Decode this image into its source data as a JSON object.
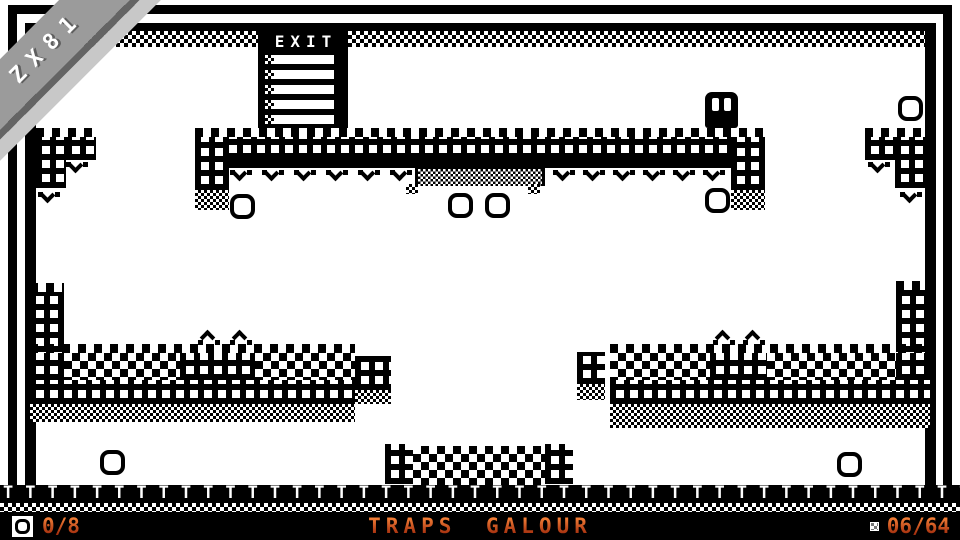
{
  "ribbon": {
    "label": "ZX81"
  },
  "exit_sign": {
    "label": "EXIT",
    "rung_count": 5
  },
  "hud": {
    "coin_counter": "0/8",
    "level_title": "TRAPS GALOUR",
    "block_counter": "06/64"
  },
  "colors": {
    "hud_accent_top": "#f58138",
    "hud_accent_bottom": "#992408",
    "ribbon_gray": "#9b9b9b",
    "ribbon_dark_edge": "#646464",
    "ribbon_light_shadow": "#c8c8c8",
    "ink": "#000000",
    "paper": "#ffffff"
  },
  "rail": {
    "post_count": 44
  },
  "level": {
    "blocks": [
      {
        "t": "dither4",
        "x": 36,
        "y": 31,
        "w": 889,
        "h": 16
      },
      {
        "t": "teeth",
        "x": 195,
        "y": 128,
        "w": 570,
        "h": 9
      },
      {
        "t": "lattice",
        "x": 195,
        "y": 137,
        "w": 570,
        "h": 22
      },
      {
        "t": "solid",
        "x": 195,
        "y": 159,
        "w": 570,
        "h": 9
      },
      {
        "t": "lattice",
        "x": 195,
        "y": 137,
        "w": 34,
        "h": 53
      },
      {
        "t": "dither",
        "x": 195,
        "y": 190,
        "w": 34,
        "h": 20
      },
      {
        "t": "lattice",
        "x": 731,
        "y": 137,
        "w": 34,
        "h": 53
      },
      {
        "t": "dither",
        "x": 731,
        "y": 190,
        "w": 34,
        "h": 20
      },
      {
        "t": "conveyor",
        "x": 415,
        "y": 166,
        "w": 130,
        "h": 20
      },
      {
        "t": "dither",
        "x": 406,
        "y": 184,
        "w": 12,
        "h": 10
      },
      {
        "t": "dither",
        "x": 528,
        "y": 184,
        "w": 12,
        "h": 10
      },
      {
        "t": "teeth",
        "x": 36,
        "y": 128,
        "w": 60,
        "h": 9
      },
      {
        "t": "lattice",
        "x": 36,
        "y": 137,
        "w": 30,
        "h": 51
      },
      {
        "t": "lattice",
        "x": 66,
        "y": 137,
        "w": 30,
        "h": 23
      },
      {
        "t": "teeth",
        "x": 865,
        "y": 128,
        "w": 60,
        "h": 9
      },
      {
        "t": "lattice",
        "x": 895,
        "y": 137,
        "w": 30,
        "h": 51
      },
      {
        "t": "lattice",
        "x": 865,
        "y": 137,
        "w": 30,
        "h": 23
      },
      {
        "t": "teeth",
        "x": 30,
        "y": 283,
        "w": 34,
        "h": 9
      },
      {
        "t": "lattice",
        "x": 30,
        "y": 292,
        "w": 34,
        "h": 60
      },
      {
        "t": "teeth",
        "x": 896,
        "y": 281,
        "w": 34,
        "h": 9
      },
      {
        "t": "lattice",
        "x": 896,
        "y": 290,
        "w": 34,
        "h": 62
      },
      {
        "t": "teeth",
        "x": 30,
        "y": 344,
        "w": 325,
        "h": 9
      },
      {
        "t": "lattice",
        "x": 30,
        "y": 353,
        "w": 34,
        "h": 27
      },
      {
        "t": "checker",
        "x": 64,
        "y": 353,
        "w": 116,
        "h": 27
      },
      {
        "t": "lattice",
        "x": 180,
        "y": 353,
        "w": 75,
        "h": 27
      },
      {
        "t": "checker",
        "x": 255,
        "y": 353,
        "w": 100,
        "h": 27
      },
      {
        "t": "lattice",
        "x": 30,
        "y": 380,
        "w": 325,
        "h": 24
      },
      {
        "t": "dither",
        "x": 30,
        "y": 404,
        "w": 325,
        "h": 18
      },
      {
        "t": "lattice",
        "x": 355,
        "y": 356,
        "w": 36,
        "h": 34
      },
      {
        "t": "dither",
        "x": 355,
        "y": 390,
        "w": 36,
        "h": 14
      },
      {
        "t": "teeth",
        "x": 610,
        "y": 344,
        "w": 320,
        "h": 9
      },
      {
        "t": "checker",
        "x": 610,
        "y": 353,
        "w": 100,
        "h": 27
      },
      {
        "t": "lattice",
        "x": 710,
        "y": 353,
        "w": 57,
        "h": 27
      },
      {
        "t": "checker",
        "x": 767,
        "y": 353,
        "w": 129,
        "h": 27
      },
      {
        "t": "lattice",
        "x": 896,
        "y": 353,
        "w": 34,
        "h": 27
      },
      {
        "t": "lattice",
        "x": 610,
        "y": 380,
        "w": 320,
        "h": 24
      },
      {
        "t": "dither",
        "x": 610,
        "y": 404,
        "w": 320,
        "h": 24
      },
      {
        "t": "lattice",
        "x": 577,
        "y": 352,
        "w": 28,
        "h": 32
      },
      {
        "t": "dither",
        "x": 577,
        "y": 384,
        "w": 28,
        "h": 16
      },
      {
        "t": "lattice",
        "x": 385,
        "y": 444,
        "w": 28,
        "h": 40
      },
      {
        "t": "checker",
        "x": 413,
        "y": 446,
        "w": 132,
        "h": 39
      },
      {
        "t": "lattice",
        "x": 545,
        "y": 444,
        "w": 28,
        "h": 40
      }
    ],
    "spikes_down": [
      {
        "x": 230,
        "y": 170
      },
      {
        "x": 262,
        "y": 170
      },
      {
        "x": 294,
        "y": 170
      },
      {
        "x": 326,
        "y": 170
      },
      {
        "x": 358,
        "y": 170
      },
      {
        "x": 390,
        "y": 170
      },
      {
        "x": 553,
        "y": 170
      },
      {
        "x": 583,
        "y": 170
      },
      {
        "x": 613,
        "y": 170
      },
      {
        "x": 643,
        "y": 170
      },
      {
        "x": 673,
        "y": 170
      },
      {
        "x": 703,
        "y": 170
      },
      {
        "x": 66,
        "y": 162
      },
      {
        "x": 38,
        "y": 192
      },
      {
        "x": 868,
        "y": 162
      },
      {
        "x": 900,
        "y": 192
      }
    ],
    "spikes_up": [
      {
        "x": 198,
        "y": 327
      },
      {
        "x": 230,
        "y": 327
      },
      {
        "x": 713,
        "y": 327
      },
      {
        "x": 743,
        "y": 327
      }
    ],
    "coins": [
      {
        "x": 230,
        "y": 194
      },
      {
        "x": 448,
        "y": 193
      },
      {
        "x": 485,
        "y": 193
      },
      {
        "x": 705,
        "y": 188
      },
      {
        "x": 898,
        "y": 96
      },
      {
        "x": 100,
        "y": 450
      },
      {
        "x": 837,
        "y": 452
      }
    ],
    "enemy": {
      "x": 705,
      "y": 92
    }
  }
}
